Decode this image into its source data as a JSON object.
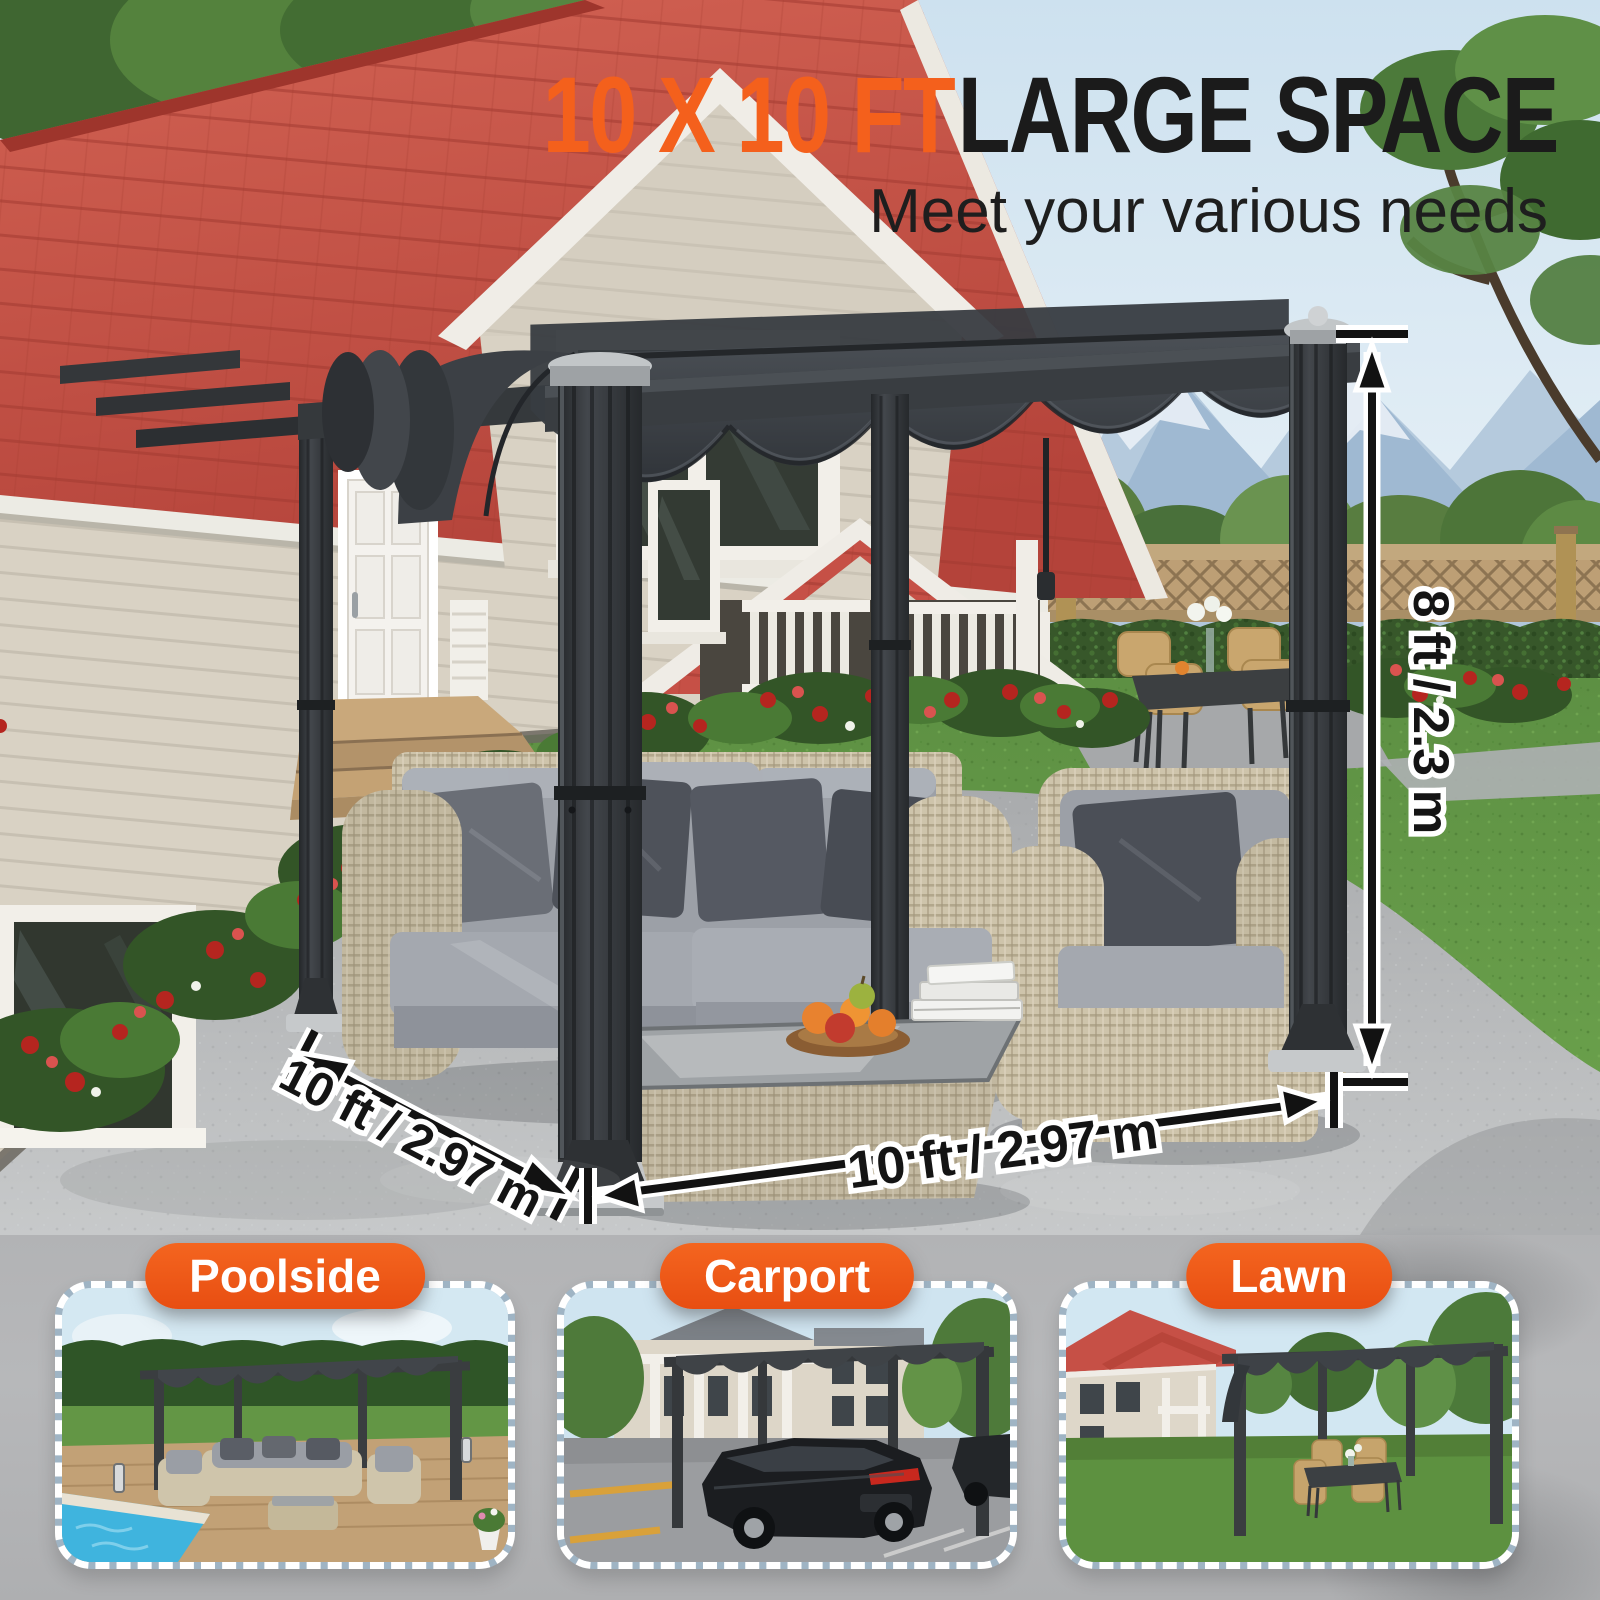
{
  "page": {
    "width": 1600,
    "height": 1600
  },
  "colors": {
    "accent_orange": "#F4601C",
    "badge_orange": "#F15A1E",
    "headline_dark": "#1B1B1B",
    "annotation_text": "#141414",
    "annotation_outline": "#FFFFFF",
    "pergola_charcoal": "#3A3D41",
    "canopy_gray": "#41454A",
    "roof_red": "#C85045",
    "siding_beige": "#D9D2C4",
    "lawn_green": "#649A47",
    "patio_gray": "#B8BABC"
  },
  "headline": {
    "highlight": "10 X 10 FT",
    "rest": "LARGE SPACE",
    "subtitle": "Meet your various needs"
  },
  "annotations": {
    "height_label": "8 ft / 2.3 m",
    "depth_label": "10 ft / 2.97 m",
    "width_label": "10 ft / 2.97 m"
  },
  "use_cases": [
    {
      "label": "Poolside"
    },
    {
      "label": "Carport"
    },
    {
      "label": "Lawn"
    }
  ]
}
